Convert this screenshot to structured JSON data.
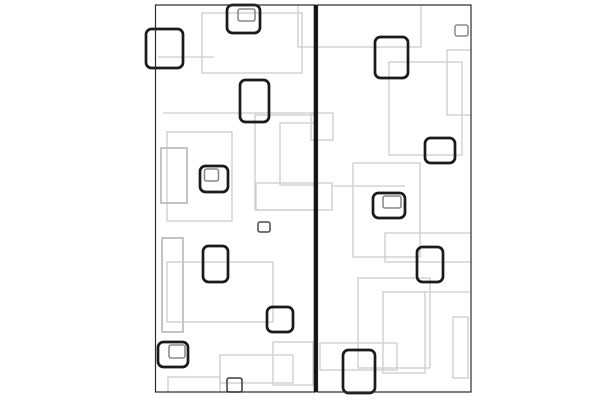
{
  "canvas": {
    "width": 600,
    "height": 400,
    "background": "#ffffff"
  },
  "artwork": {
    "description": "abstract-pattern-of-nested-rectangles-two-panels",
    "colors": {
      "background": "#ffffff",
      "bold_stroke": "#1a1a1a",
      "gray_stroke": "#cdcdcd",
      "gray_dark_stroke": "#bdbdbd",
      "inner_stroke": "#8a8a8a",
      "panel_border": "#2b2b2b",
      "divider": "#151515"
    },
    "pattern_clip": {
      "x": 156,
      "y": 5,
      "w": 315,
      "h": 387
    },
    "panels": [
      {
        "x": 155.5,
        "y": 5,
        "w": 160,
        "h": 387
      },
      {
        "x": 317.5,
        "y": 5,
        "w": 153.5,
        "h": 387
      }
    ],
    "divider": {
      "x": 313.7,
      "y": 5,
      "w": 3.8,
      "h": 387
    },
    "gray_rects": [
      {
        "x": 202,
        "y": 13,
        "w": 100,
        "h": 60
      },
      {
        "x": 158,
        "y": 57,
        "w": 56,
        "h": 0
      },
      {
        "x": 163,
        "y": 113,
        "w": 152,
        "h": 0
      },
      {
        "x": 311,
        "y": 113,
        "w": 22,
        "h": 27
      },
      {
        "x": 255,
        "y": 115,
        "w": 62,
        "h": 95
      },
      {
        "x": 167,
        "y": 132,
        "w": 65,
        "h": 89
      },
      {
        "x": 161,
        "y": 148,
        "w": 26,
        "h": 55,
        "shade": "dark"
      },
      {
        "x": 280,
        "y": 123,
        "w": 35,
        "h": 62
      },
      {
        "x": 256,
        "y": 183,
        "w": 76,
        "h": 27
      },
      {
        "x": 332,
        "y": 186,
        "w": 73,
        "h": 0
      },
      {
        "x": 162,
        "y": 238,
        "w": 21,
        "h": 94,
        "shade": "dark"
      },
      {
        "x": 167,
        "y": 262,
        "w": 106,
        "h": 60
      },
      {
        "x": 168,
        "y": 377,
        "w": 52,
        "h": 23
      },
      {
        "x": 220,
        "y": 355,
        "w": 73,
        "h": 28
      },
      {
        "x": 273,
        "y": 342,
        "w": 40,
        "h": 43
      },
      {
        "x": 298,
        "y": -15,
        "w": 123,
        "h": 62
      },
      {
        "x": 389,
        "y": 62,
        "w": 73,
        "h": 93
      },
      {
        "x": 447,
        "y": 50,
        "w": 26,
        "h": 65
      },
      {
        "x": 353,
        "y": 163,
        "w": 67,
        "h": 94
      },
      {
        "x": 385,
        "y": 233,
        "w": 88,
        "h": 29
      },
      {
        "x": 358,
        "y": 278,
        "w": 72,
        "h": 90
      },
      {
        "x": 383,
        "y": 292,
        "w": 42,
        "h": 81
      },
      {
        "x": 425,
        "y": 292,
        "w": 45,
        "h": 0
      },
      {
        "x": 453,
        "y": 317,
        "w": 15,
        "h": 61
      },
      {
        "x": 320,
        "y": 343,
        "w": 77,
        "h": 27
      }
    ],
    "bold_rects": [
      {
        "x": 227,
        "y": 5,
        "w": 33,
        "h": 28,
        "inner": {
          "x": 238,
          "y": 9,
          "w": 17,
          "h": 12
        }
      },
      {
        "x": 146,
        "y": 29,
        "w": 37,
        "h": 39
      },
      {
        "x": 240,
        "y": 80,
        "w": 29,
        "h": 42
      },
      {
        "x": 200,
        "y": 166,
        "w": 28,
        "h": 26,
        "inner": {
          "x": 204.5,
          "y": 169,
          "w": 14,
          "h": 12
        }
      },
      {
        "x": 203,
        "y": 246,
        "w": 25,
        "h": 36
      },
      {
        "x": 267,
        "y": 307,
        "w": 26,
        "h": 25
      },
      {
        "x": 158,
        "y": 342,
        "w": 30,
        "h": 25,
        "inner": {
          "x": 169,
          "y": 345,
          "w": 16,
          "h": 13
        }
      },
      {
        "x": 375,
        "y": 37,
        "w": 33,
        "h": 41
      },
      {
        "x": 425,
        "y": 138,
        "w": 30,
        "h": 25
      },
      {
        "x": 373,
        "y": 193,
        "w": 32,
        "h": 25,
        "inner": {
          "x": 383,
          "y": 196,
          "w": 18,
          "h": 12
        }
      },
      {
        "x": 417,
        "y": 247,
        "w": 26,
        "h": 35
      },
      {
        "x": 343,
        "y": 350,
        "w": 32,
        "h": 43
      }
    ],
    "small_squares": [
      {
        "x": 258,
        "y": 222,
        "w": 12,
        "h": 10,
        "stroke": "#4a4a4a"
      },
      {
        "x": 227,
        "y": 378,
        "w": 15,
        "h": 14,
        "stroke": "#3a3a3a"
      },
      {
        "x": 455,
        "y": 25,
        "w": 13,
        "h": 11,
        "stroke": "#8a8a8a"
      }
    ]
  }
}
